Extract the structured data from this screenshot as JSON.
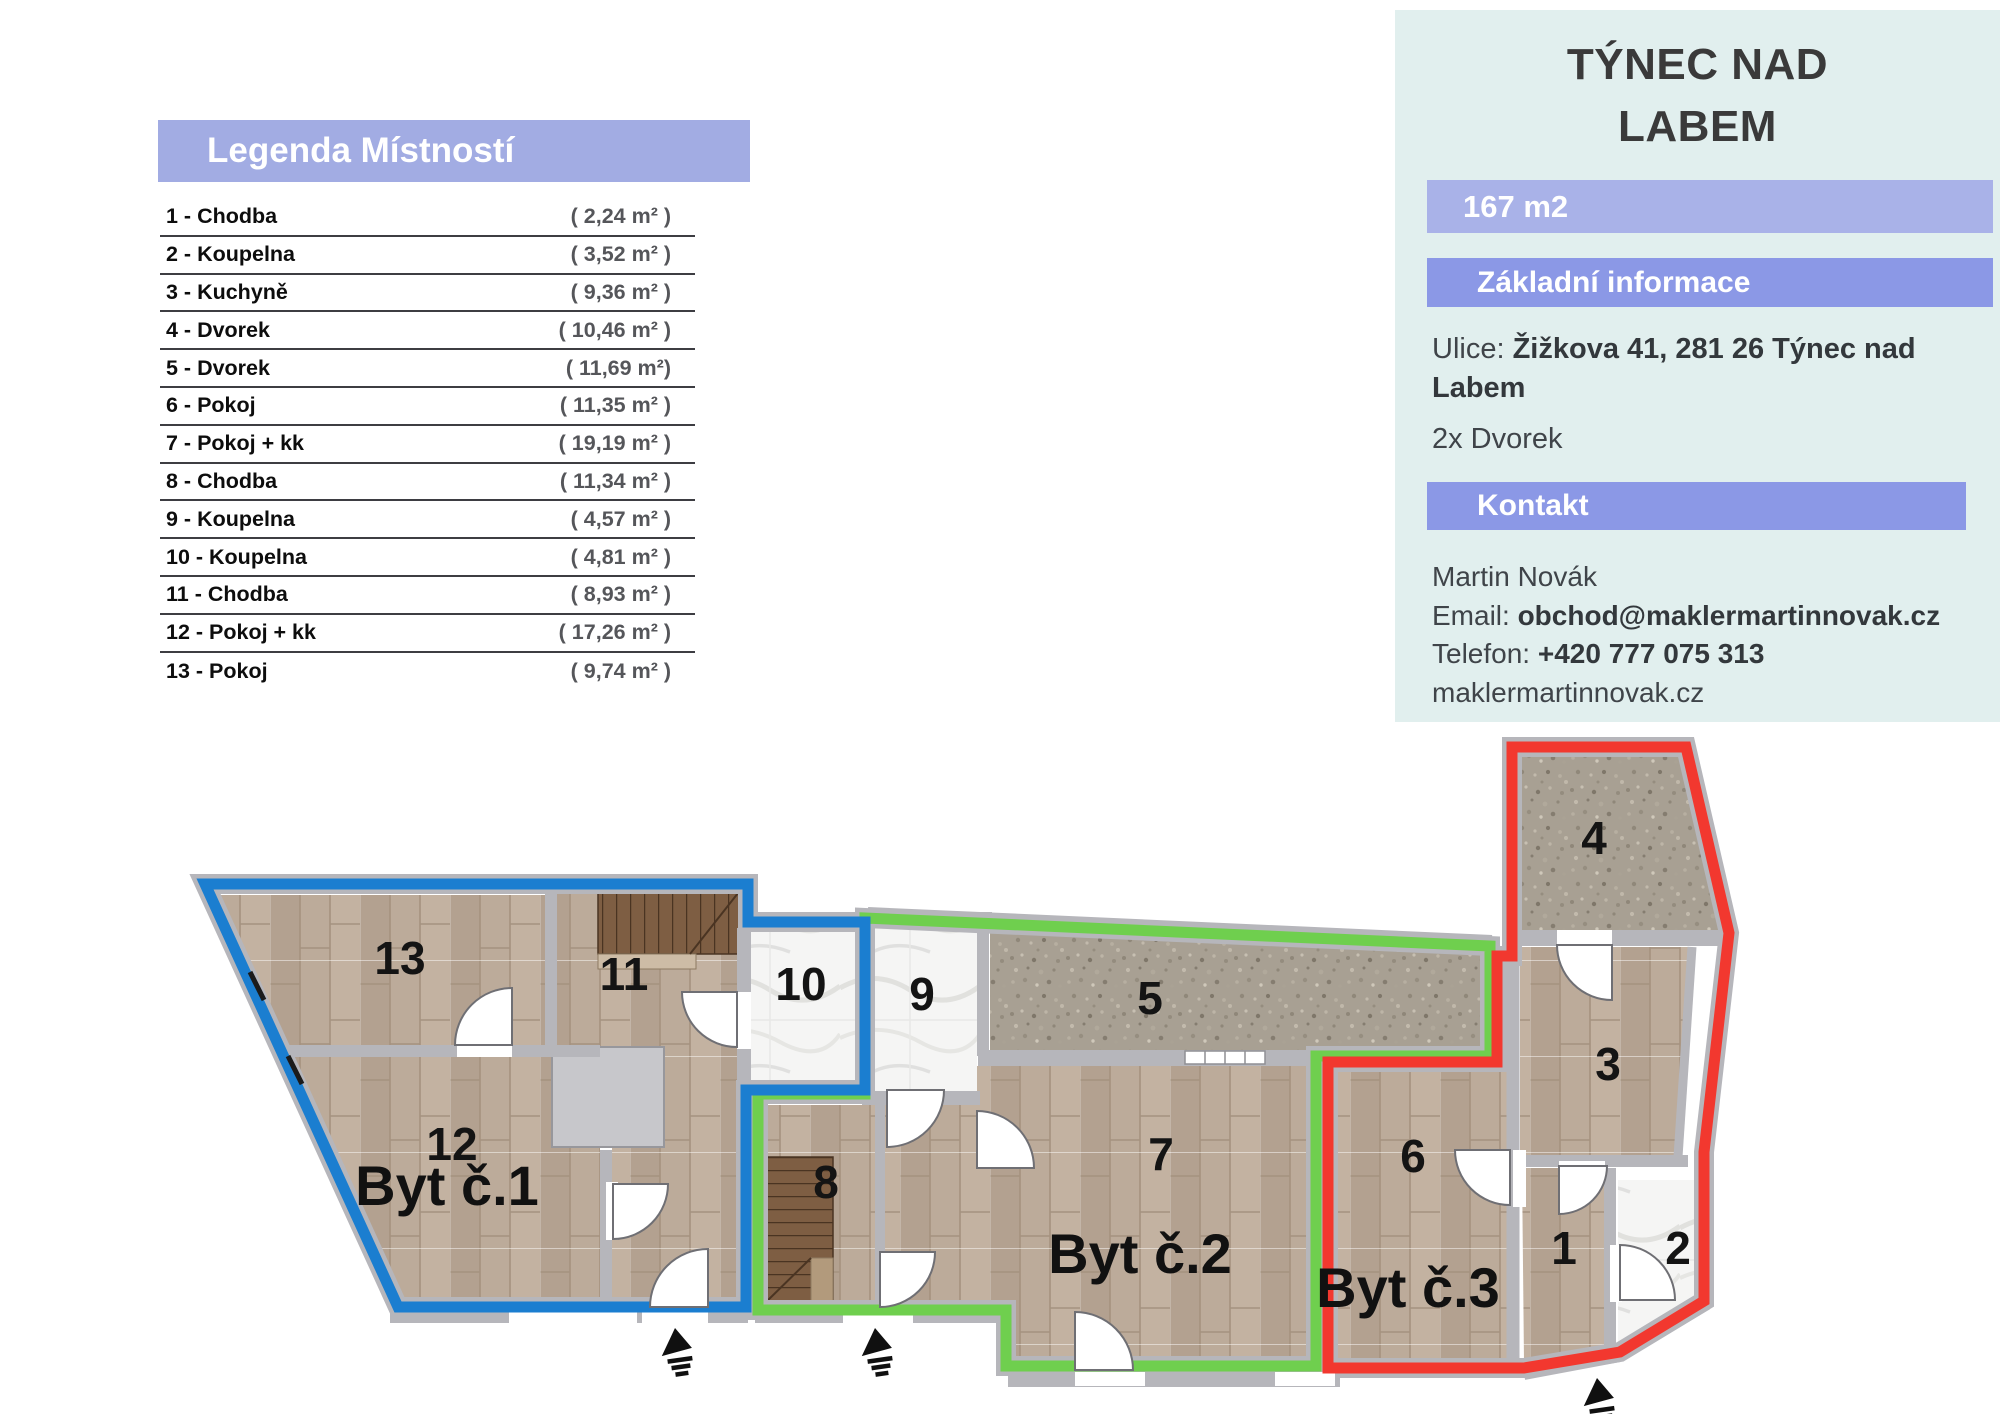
{
  "legend": {
    "title": "Legenda Místností",
    "rows": [
      {
        "name": "1 - Chodba",
        "area": "( 2,24 m² )"
      },
      {
        "name": "2 - Koupelna",
        "area": "( 3,52 m² )"
      },
      {
        "name": "3 - Kuchyně",
        "area": "( 9,36 m² )"
      },
      {
        "name": "4 - Dvorek",
        "area": "( 10,46 m² )"
      },
      {
        "name": "5 - Dvorek",
        "area": "( 11,69 m²)"
      },
      {
        "name": "6 - Pokoj",
        "area": "( 11,35 m² )"
      },
      {
        "name": "7 - Pokoj + kk",
        "area": "( 19,19 m² )"
      },
      {
        "name": "8 - Chodba",
        "area": "( 11,34 m² )"
      },
      {
        "name": "9 - Koupelna",
        "area": "( 4,57 m² )"
      },
      {
        "name": "10 - Koupelna",
        "area": "( 4,81 m² )"
      },
      {
        "name": "11 - Chodba",
        "area": "( 8,93 m² )"
      },
      {
        "name": "12 - Pokoj + kk",
        "area": "( 17,26 m² )"
      },
      {
        "name": "13 - Pokoj",
        "area": "( 9,74 m² )"
      }
    ]
  },
  "info_panel": {
    "title_line1": "TÝNEC NAD",
    "title_line2": "LABEM",
    "area_badge": "167 m2",
    "section_basic": "Základní informace",
    "street_label": "Ulice: ",
    "street_value": "Žižkova 41, 281 26 Týnec nad Labem",
    "feature": "2x Dvorek",
    "section_contact": "Kontakt",
    "contact_name": "Martin Novák",
    "email_label": "Email: ",
    "email_value": "obchod@maklermartinnovak.cz",
    "phone_label": "Telefon: ",
    "phone_value": "+420 777 075 313",
    "website": "maklermartinnovak.cz"
  },
  "plan": {
    "rooms": [
      {
        "id": "1",
        "number": "1"
      },
      {
        "id": "2",
        "number": "2"
      },
      {
        "id": "3",
        "number": "3"
      },
      {
        "id": "4",
        "number": "4"
      },
      {
        "id": "5",
        "number": "5"
      },
      {
        "id": "6",
        "number": "6"
      },
      {
        "id": "7",
        "number": "7"
      },
      {
        "id": "8",
        "number": "8"
      },
      {
        "id": "9",
        "number": "9"
      },
      {
        "id": "10",
        "number": "10"
      },
      {
        "id": "11",
        "number": "11"
      },
      {
        "id": "12",
        "number": "12"
      },
      {
        "id": "13",
        "number": "13"
      }
    ],
    "apartments": [
      {
        "id": "byt1",
        "label": "Byt č.1",
        "color": "#1b7ed0"
      },
      {
        "id": "byt2",
        "label": "Byt č.2",
        "color": "#6fcf4e"
      },
      {
        "id": "byt3",
        "label": "Byt č.3",
        "color": "#f2382f"
      }
    ]
  },
  "colors": {
    "legend_header_bg": "#a2ace3",
    "badge_bg": "#a9b2e8",
    "section_bg": "#8b98e6",
    "panel_bg": "#e1efee",
    "outline_blue": "#1b7ed0",
    "outline_green": "#6fcf4e",
    "outline_red": "#f2382f"
  }
}
